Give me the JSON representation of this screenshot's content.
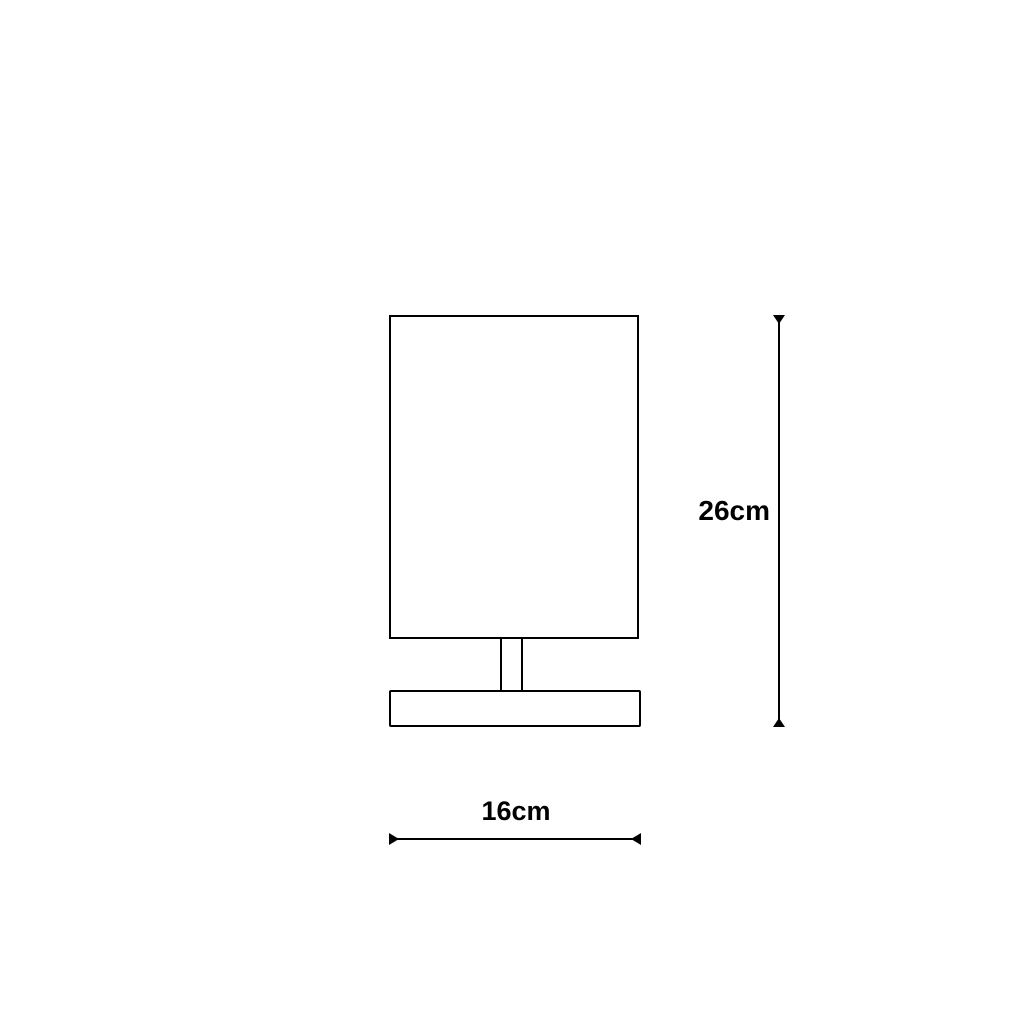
{
  "diagram": {
    "type": "product-dimension-drawing",
    "subject": "table lamp front view",
    "background_color": "#ffffff",
    "line_color": "#000000",
    "parts": {
      "shade": "rectangular lamp shade",
      "stem": "narrow stem",
      "base": "flat rectangular base"
    },
    "height_dimension": {
      "label": "26cm",
      "orientation": "vertical"
    },
    "width_dimension": {
      "label": "16cm",
      "orientation": "horizontal"
    }
  }
}
